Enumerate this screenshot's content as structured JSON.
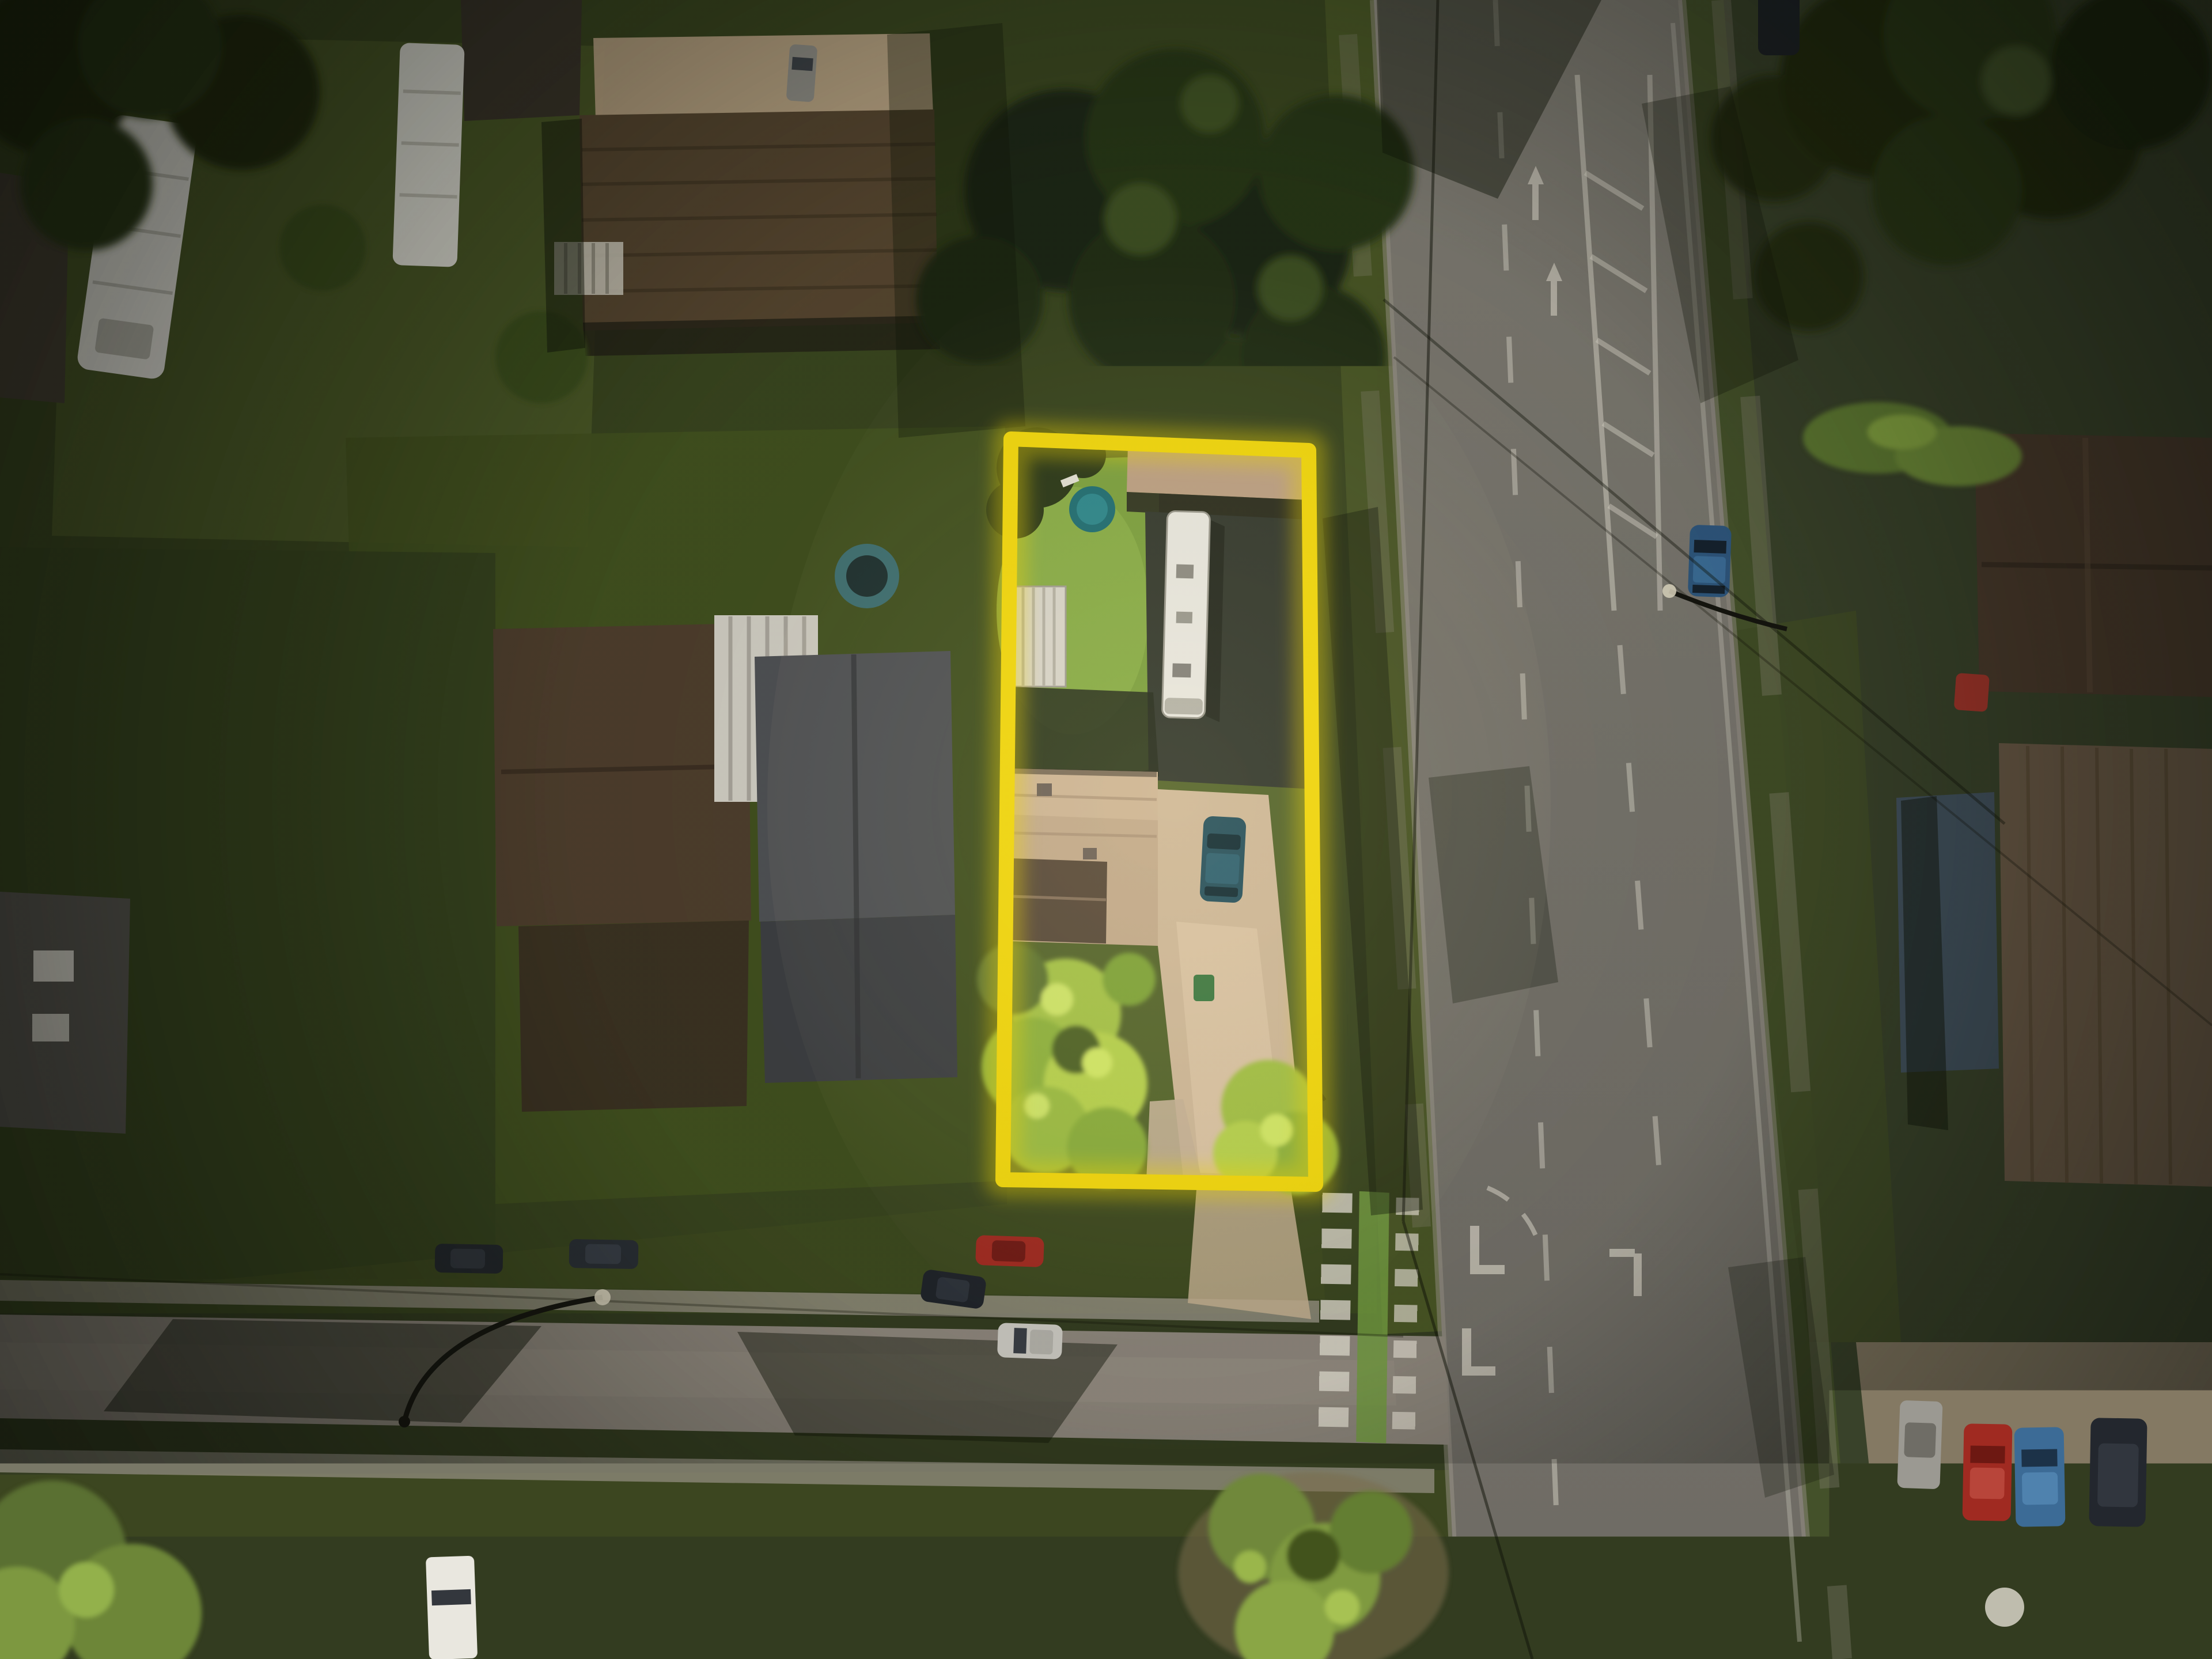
{
  "meta": {
    "type": "aerial-drone-photograph",
    "subject": "suburban residential neighborhood at a road intersection, dusk lighting with dark vignette",
    "visible_text": "none"
  },
  "annotation": {
    "boundary_label": "property-boundary-highlight",
    "boundary_shape": "slightly-tilted rectangle outline",
    "boundary_color": "#f2d70c",
    "boundary_glow": "rgba(243,216,10,0.38)"
  },
  "scene": {
    "highlighted_lot_contents": [
      "back lawn",
      "round pool",
      "white rv trailer",
      "carport roof",
      "white corrugated shed",
      "tan shingle house roof",
      "concrete driveway",
      "dark teal parked car",
      "green garbage bin",
      "bright trees"
    ],
    "roads": {
      "main_road": "wide vertical arterial on right with dashed lanes, median chevrons, turn arrows, stop bars",
      "side_street": "horizontal residential street at bottom",
      "crosswalk": "ladder crosswalk with green bike-crossing strip across side street"
    },
    "vehicles": [
      "white motorhome top-left",
      "white trailer top-center-left",
      "gray car top-center",
      "dark car on arterial top",
      "blue car driving on arterial",
      "red parked car below lot",
      "dark parked cars on side street",
      "silver suv driving on side street",
      "white truck bottom-left",
      "red car right driveway",
      "car row bottom-right: gray, red, blue, dark suv"
    ],
    "lighting": "low warm sun from south-east, long shadows, strong corner darkening, lot area brightest"
  },
  "colors": {
    "ground": "#333c20",
    "lawnDark": "#39451f",
    "lawnMid": "#4c5a28",
    "lawnBright": "#7ca03e",
    "treeDark": "#222b13",
    "treeMid": "#2f3d1a",
    "treeBright": "#9dbd45",
    "road": "#76736c",
    "sideStreet": "#8b847a",
    "sidewalk": "#9c968a",
    "marking": "#ded9cc",
    "bikeGreen": "#71993f",
    "roofTan": "#c3aa8b",
    "roofBrown": "#55452f",
    "roofGray": "#4f5154",
    "rvWhite": "#e9e7df",
    "shedWhite": "#d9d5ca",
    "poolTeal": "#1f6d72",
    "driveway": "#cfb898",
    "carBlue": "#2e567c",
    "carRed": "#a02a21",
    "carDark": "#23272c",
    "carSilver": "#c9c7c0",
    "binGreen": "#3f7a42",
    "accent": "#f2d70c"
  }
}
